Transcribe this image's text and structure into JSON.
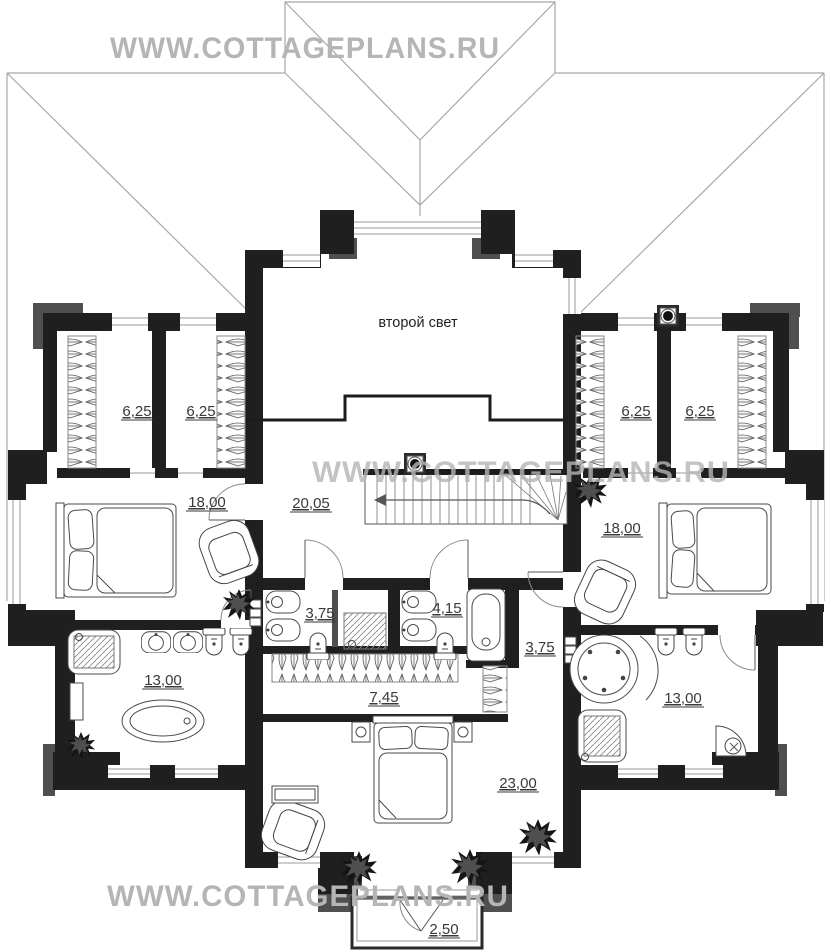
{
  "watermarks": {
    "top": "WWW.COTTAGEPLANS.RU",
    "middle": "WWW.COTTAGEPLANS.RU",
    "bottom": "WWW.COTTAGEPLANS.RU"
  },
  "plan": {
    "second_light_label": "второй свет",
    "areas": {
      "wardrobe_left_1": "6,25",
      "wardrobe_left_2": "6,25",
      "wardrobe_right_1": "6,25",
      "wardrobe_right_2": "6,25",
      "bedroom_left": "18,00",
      "hall": "20,05",
      "bedroom_right": "18,00",
      "bath_left": "3,75",
      "bath_center": "4,15",
      "hallway_right": "3,75",
      "corridor_wardrobe": "7,45",
      "bath_master_left": "13,00",
      "bath_master_right": "13,00",
      "bedroom_bottom": "23,00",
      "balcony": "2,50"
    }
  },
  "colors": {
    "wall": "#1f1f1f",
    "wall_accent": "#4f4f4f",
    "roof_line": "#a8a8a8",
    "watermark": "#b5b5b5",
    "label": "#3a3a3a"
  }
}
